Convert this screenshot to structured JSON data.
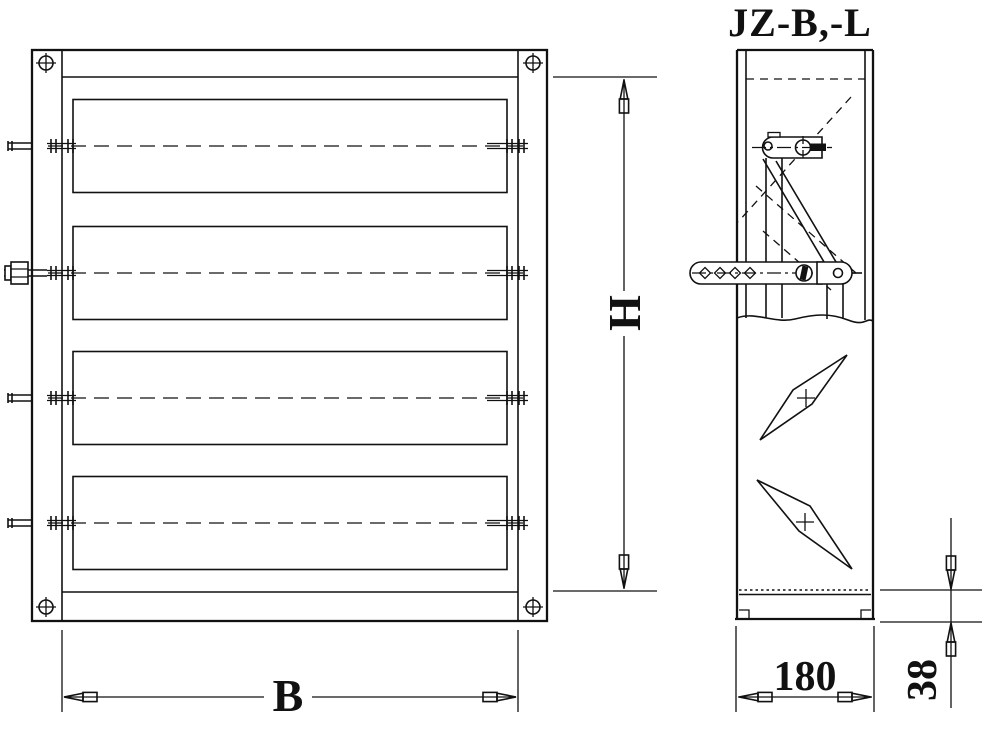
{
  "title": "JZ-B,-L",
  "dimensions": {
    "width_label": "B",
    "height_label": "H",
    "depth_label": "180",
    "bottom_rail_label": "38"
  },
  "front_view": {
    "blade_panels": 4
  },
  "side_view": {
    "blade_profiles": 2
  },
  "colors": {
    "line": "#111111",
    "background": "#ffffff"
  }
}
